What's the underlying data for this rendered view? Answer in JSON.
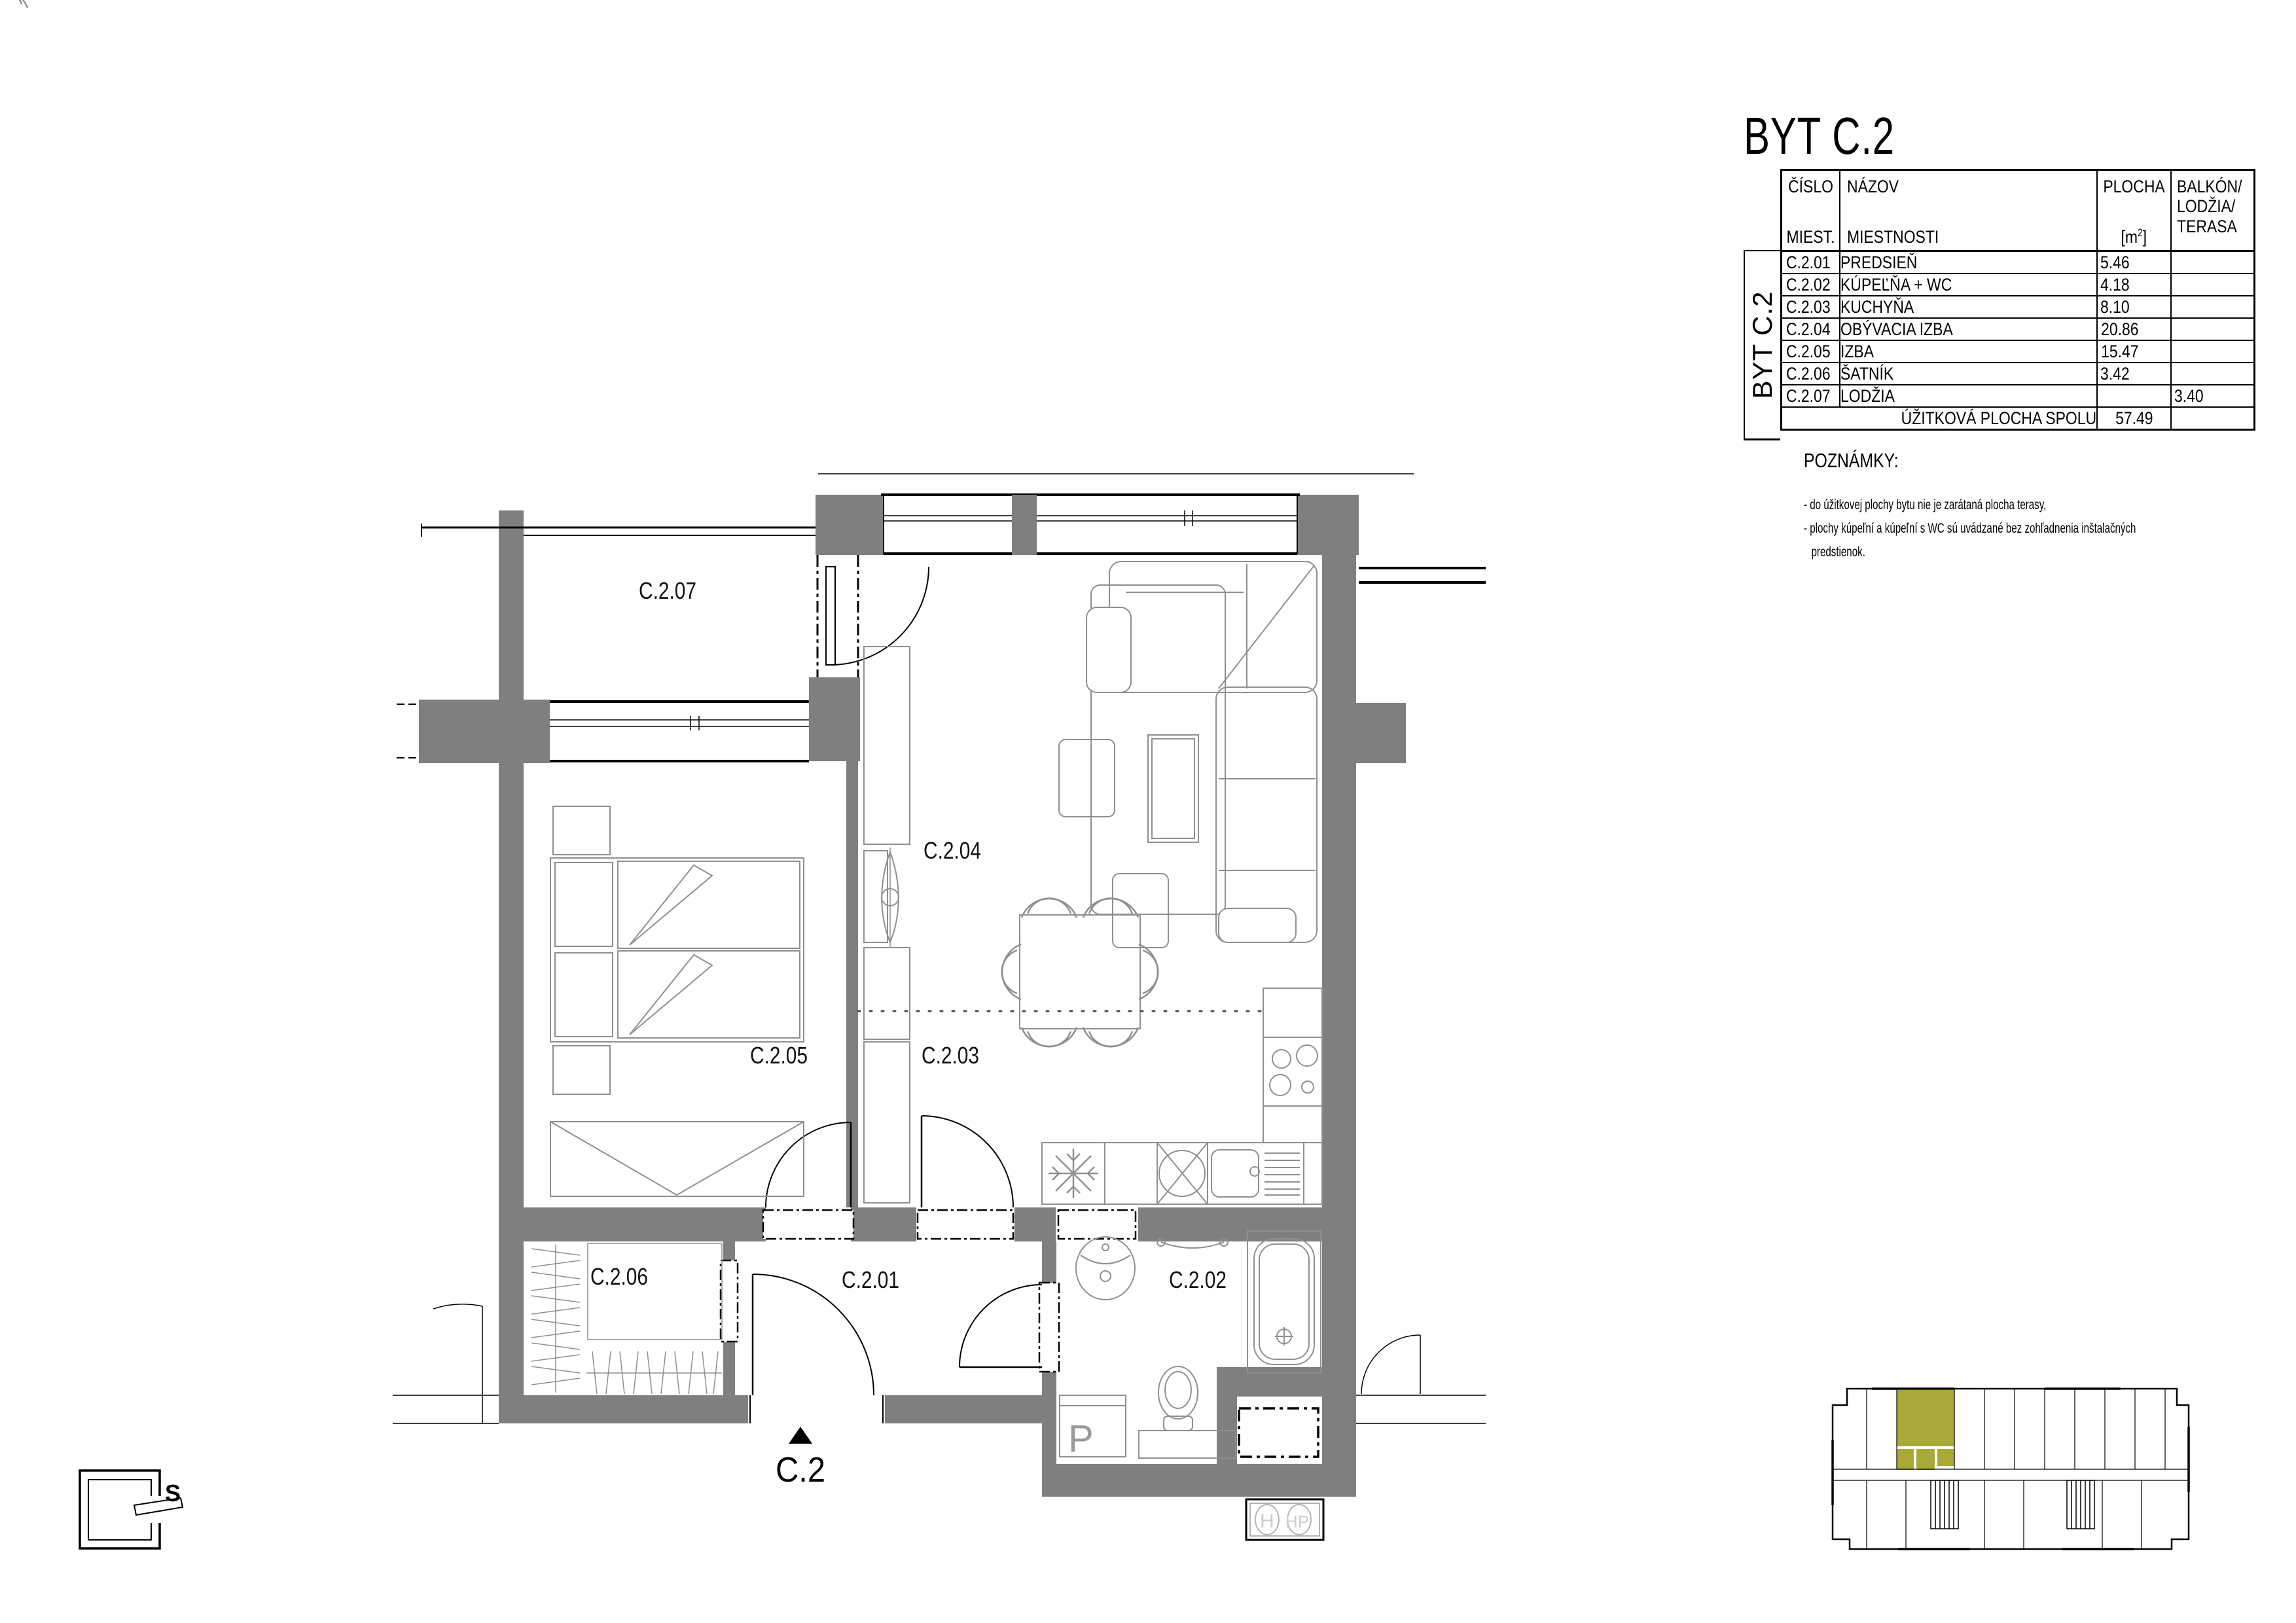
{
  "title": "BYT C.2",
  "table": {
    "sidebar_label": "BYT C.2",
    "headers": {
      "col1_line1": "ČÍSLO",
      "col1_line2": "MIEST.",
      "col2_line1": "NÁZOV",
      "col2_line2": "MIESTNOSTI",
      "col3_line1": "PLOCHA",
      "unit_open": "[m",
      "unit_sup": "2",
      "unit_close": "]",
      "col4_line1": "BALKÓN/",
      "col4_line2": "LODŽIA/",
      "col4_line3": "TERASA"
    },
    "rows": [
      {
        "no": "C.2.01",
        "name": "PREDSIEŇ",
        "area": "5.46",
        "balcony": ""
      },
      {
        "no": "C.2.02",
        "name": "KÚPEĽŇA + WC",
        "area": "4.18",
        "balcony": ""
      },
      {
        "no": "C.2.03",
        "name": "KUCHYŇA",
        "area": "8.10",
        "balcony": ""
      },
      {
        "no": "C.2.04",
        "name": "OBÝVACIA IZBA",
        "area": "20.86",
        "balcony": ""
      },
      {
        "no": "C.2.05",
        "name": "IZBA",
        "area": "15.47",
        "balcony": ""
      },
      {
        "no": "C.2.06",
        "name": "ŠATNÍK",
        "area": "3.42",
        "balcony": ""
      },
      {
        "no": "C.2.07",
        "name": "LODŽIA",
        "area": "",
        "balcony": "3.40"
      }
    ],
    "footer": {
      "label": "ÚŽITKOVÁ PLOCHA SPOLU",
      "total": "57.49"
    }
  },
  "notes": {
    "heading": "POZNÁMKY:",
    "lines": [
      "- do úžitkovej plochy bytu nie je zarátaná plocha terasy,",
      "- plochy kúpeľní a kúpeľní s WC sú uvádzané bez zohľadnenia inštalačných",
      "predstienok."
    ]
  },
  "plan": {
    "room_labels": [
      "C.2.01",
      "C.2.02",
      "C.2.03",
      "C.2.04",
      "C.2.05",
      "C.2.06",
      "C.2.07"
    ],
    "entrance_label": "C.2",
    "north_label": "S",
    "washer_label": "P",
    "meter_labels": [
      "H",
      "HP"
    ],
    "colors": {
      "wall": "#7f7f7f",
      "furniture_line": "#8f8f8f",
      "keyplan_highlight": "#a9a93a"
    }
  }
}
